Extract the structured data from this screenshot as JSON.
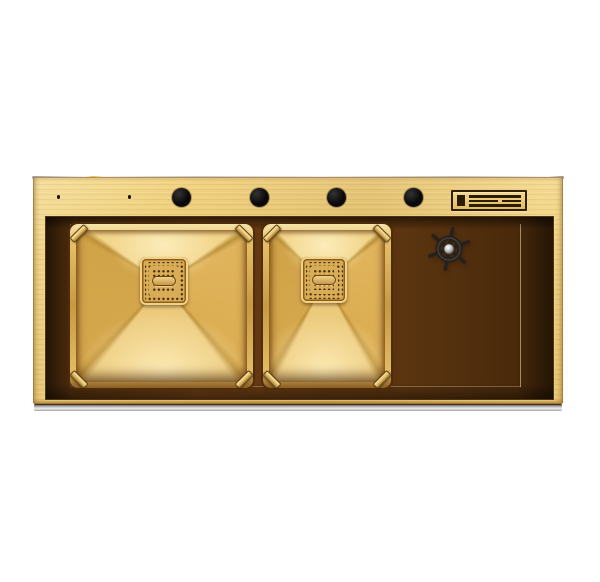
{
  "image": {
    "type": "product-photo",
    "subject": "Brushed gold double-bowl drop-in kitchen sink, front top view",
    "background_color": "#ffffff"
  },
  "palette": {
    "deck_gold": "#eac76c",
    "deck_gold_light": "#f2d585",
    "deck_gold_deep": "#e2bb5f",
    "rim_highlight": "#f6e4a8",
    "bowl_top_face": "#f2d58c",
    "bowl_side_face": "#dcae53",
    "bowl_left_face": "#d2a449",
    "bowl_bottom_face": "#ecca7c",
    "fold_line": "#bd923a",
    "recess_brown": "#54300e",
    "recess_brown_dark": "#2e1a06",
    "drain_gold": "#d9ad55",
    "drain_dot": "#40270a",
    "hole_black": "#0a0a0a",
    "wheel_dark": "#26211c",
    "hub_silver": "#d9d9db",
    "edge_silver": "#cfd0d3"
  },
  "deck": {
    "faucet_hole_count": 4,
    "pilot_hole_count": 2,
    "brand_plate": {
      "elements": [
        "vertical-bar",
        "full-line",
        "split-line",
        "full-line"
      ]
    }
  },
  "basins": {
    "count": 2,
    "left": {
      "drain": {
        "shape": "square-perforated",
        "handle": "pill"
      }
    },
    "right": {
      "drain": {
        "shape": "square-perforated",
        "handle": "pill"
      }
    },
    "corner_clamps_per_basin": 4
  },
  "drainboard": {
    "control": "ship-wheel-knob",
    "wheel_spokes": 6
  },
  "aria": {
    "stage": "Product photo of a gold double-bowl kitchen sink on white background",
    "sink": "Brushed gold kitchen sink body",
    "top_edge": "Polished top rim edge",
    "front_edge": "Polished stainless front edge strip",
    "faucet_hole": "Faucet mounting hole",
    "pilot_hole": "Small pilot hole",
    "brand_plate": "Embossed brand plate",
    "recess": "Recessed basin tray",
    "floor": "Gold tray floor",
    "left_basin": "Left sink basin",
    "right_basin": "Right sink basin",
    "drain": "Square perforated drain cover with pill handle",
    "clamp": "Corner clamp",
    "drainboard_wheel": "Ship-wheel style drain control knob"
  }
}
